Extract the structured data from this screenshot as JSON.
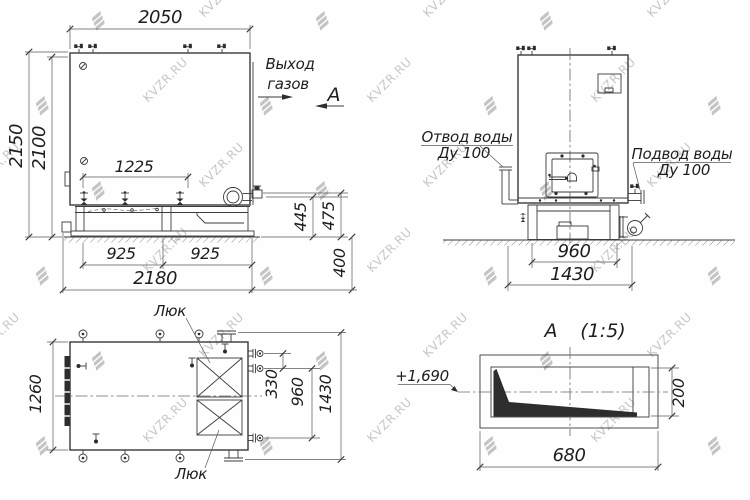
{
  "watermark": {
    "text": "KVZR.RU"
  },
  "front_view": {
    "dim_width_top": "2050",
    "dim_height_total": "2150",
    "dim_height_body": "2100",
    "dim_valve_span": "1225",
    "dim_base_left": "925",
    "dim_base_right": "925",
    "dim_base_total": "2180",
    "dim_h445": "445",
    "dim_h475": "475",
    "dim_depth": "400",
    "gas_label_1": "Выход",
    "gas_label_2": "газов",
    "section_letter": "А"
  },
  "side_view": {
    "outlet_label": "Отвод воды",
    "outlet_dn": "Ду 100",
    "inlet_label": "Подвод воды",
    "inlet_dn": "Ду 100",
    "dim_base": "960",
    "dim_total": "1430"
  },
  "top_view": {
    "hatch_label_top": "Люк",
    "hatch_label_bottom": "Люк",
    "dim_width": "1260",
    "dim_330": "330",
    "dim_960": "960",
    "dim_total": "1430"
  },
  "section_view": {
    "letter": "А",
    "scale": "(1:5)",
    "level_mark": "+1,690",
    "dim_height": "200",
    "dim_width": "680"
  }
}
